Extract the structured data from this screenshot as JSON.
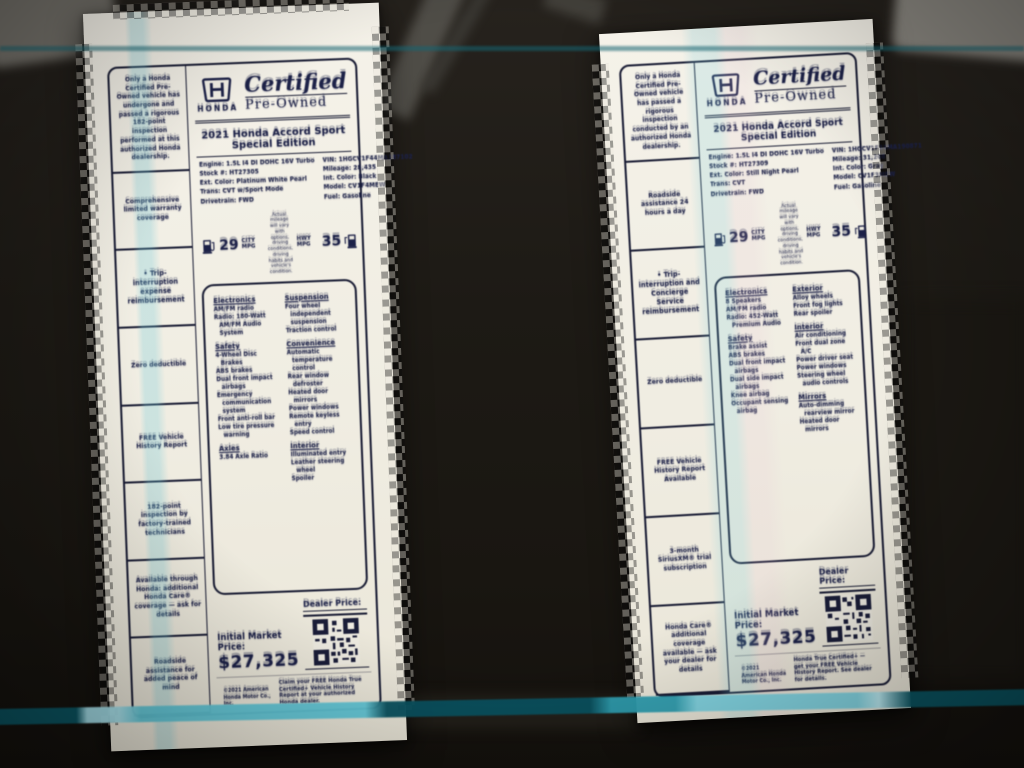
{
  "colors": {
    "teal_stripe": "#62c8d8",
    "paper": "#f0ede3",
    "ink": "#1c2147"
  },
  "stickers": [
    {
      "side_note": "Only a Honda Certified Pre-Owned vehicle has undergone and passed a rigorous 182-point inspection performed at this authorized Honda dealership.",
      "brand": {
        "honda_word": "HONDA",
        "certified": "Certified",
        "pre_owned": "Pre-Owned"
      },
      "title": "2021 Honda Accord Sport Special Edition",
      "info_left": [
        "Engine: 1.5L I4 DI DOHC 16V Turbo",
        "Stock #: HT27305",
        "Ext. Color: Platinum White Pearl",
        "Trans: CVT w/Sport Mode",
        "Drivetrain: FWD"
      ],
      "info_right": [
        "VIN: 1HGCV1F44MA187102",
        "Mileage: 28,435",
        "Int. Color: Black",
        "Model: CV1F4MEW",
        "Fuel: Gasoline"
      ],
      "epa": {
        "city_value": "29",
        "city_label": "CITY MPG",
        "hwy_value": "35",
        "hwy_label": "HWY MPG",
        "fine_print": "Actual mileage will vary with options, driving conditions, driving habits and vehicle's condition."
      },
      "features_col1": [
        {
          "header": "Electronics",
          "items": [
            "AM/FM radio",
            "Radio: 180-Watt AM/FM Audio System"
          ]
        },
        {
          "header": "Safety",
          "items": [
            "4-Wheel Disc Brakes",
            "ABS brakes",
            "Dual front impact airbags",
            "Emergency communication system",
            "Front anti-roll bar",
            "Low tire pressure warning"
          ]
        },
        {
          "header": "Axles",
          "items": [
            "3.84 Axle Ratio"
          ]
        }
      ],
      "features_col2": [
        {
          "header": "Suspension",
          "items": [
            "Four wheel independent suspension",
            "Traction control"
          ]
        },
        {
          "header": "Convenience",
          "items": [
            "Automatic temperature control",
            "Rear window defroster",
            "Heated door mirrors",
            "Power windows",
            "Remote keyless entry",
            "Speed control"
          ]
        },
        {
          "header": "Interior",
          "items": [
            "Illuminated entry",
            "Leather steering wheel",
            "Spoiler"
          ]
        }
      ],
      "sidebar_items": [
        {
          "text": "Comprehensive limited warranty coverage"
        },
        {
          "text": "• Trip-interruption expense reimbursement",
          "bold": true
        },
        {
          "text": "Zero deductible"
        },
        {
          "text": "FREE Vehicle History Report"
        },
        {
          "text": "182-point inspection by factory-trained technicians"
        },
        {
          "text": "Available through Honda: additional Honda Care® coverage — ask for details"
        },
        {
          "text": "Roadside assistance for added peace of mind"
        }
      ],
      "pricing": {
        "dealer_price_label": "Dealer Price:",
        "market_price_label": "Initial Market Price:",
        "price": "$27,325"
      },
      "footer_left": "©2021 American Honda Motor Co., Inc.",
      "footer_right": "Claim your FREE Honda True Certified+ Vehicle History Report at your authorized Honda dealer."
    },
    {
      "side_note": "Only a Honda Certified Pre-Owned vehicle has passed a rigorous inspection conducted by an authorized Honda dealership.",
      "brand": {
        "honda_word": "HONDA",
        "certified": "Certified",
        "pre_owned": "Pre-Owned"
      },
      "title": "2021 Honda Accord Sport Special Edition",
      "info_left": [
        "Engine: 1.5L I4 DI DOHC 16V Turbo",
        "Stock #: HT27309",
        "Ext. Color: Still Night Pearl",
        "Trans: CVT",
        "Drivetrain: FWD"
      ],
      "info_right": [
        "VIN: 1HGCV1F34MA190871",
        "Mileage: 31,208",
        "Int. Color: Gray",
        "Model: CV1F3MEW",
        "Fuel: Gasoline"
      ],
      "epa": {
        "city_value": "29",
        "city_label": "CITY MPG",
        "hwy_value": "35",
        "hwy_label": "HWY MPG",
        "fine_print": "Actual mileage will vary with options, driving conditions, driving habits and vehicle's condition."
      },
      "features_col1": [
        {
          "header": "Electronics",
          "items": [
            "8 Speakers",
            "AM/FM radio",
            "Radio: 452-Watt Premium Audio"
          ]
        },
        {
          "header": "Safety",
          "items": [
            "Brake assist",
            "ABS brakes",
            "Dual front impact airbags",
            "Dual side impact airbags",
            "Knee airbag",
            "Occupant sensing airbag"
          ]
        }
      ],
      "features_col2": [
        {
          "header": "Exterior",
          "items": [
            "Alloy wheels",
            "Front fog lights",
            "Rear spoiler"
          ]
        },
        {
          "header": "Interior",
          "items": [
            "Air conditioning",
            "Front dual zone A/C",
            "Power driver seat",
            "Power windows",
            "Steering wheel audio controls"
          ]
        },
        {
          "header": "Mirrors",
          "items": [
            "Auto-dimming rearview mirror",
            "Heated door mirrors"
          ]
        }
      ],
      "sidebar_items": [
        {
          "text": "Roadside assistance 24 hours a day"
        },
        {
          "text": "• Trip-interruption and Concierge Service reimbursement",
          "bold": true
        },
        {
          "text": "Zero deductible"
        },
        {
          "text": "FREE Vehicle History Report Available"
        },
        {
          "text": "3-month SiriusXM® trial subscription"
        },
        {
          "text": "Honda Care® additional coverage available — ask your dealer for details"
        }
      ],
      "pricing": {
        "dealer_price_label": "Dealer Price:",
        "market_price_label": "Initial Market Price:",
        "price": "$27,325"
      },
      "footer_left": "©2021 American Honda Motor Co., Inc.",
      "footer_right": "Honda True Certified+ — get your FREE Vehicle History Report. See dealer for details."
    }
  ]
}
